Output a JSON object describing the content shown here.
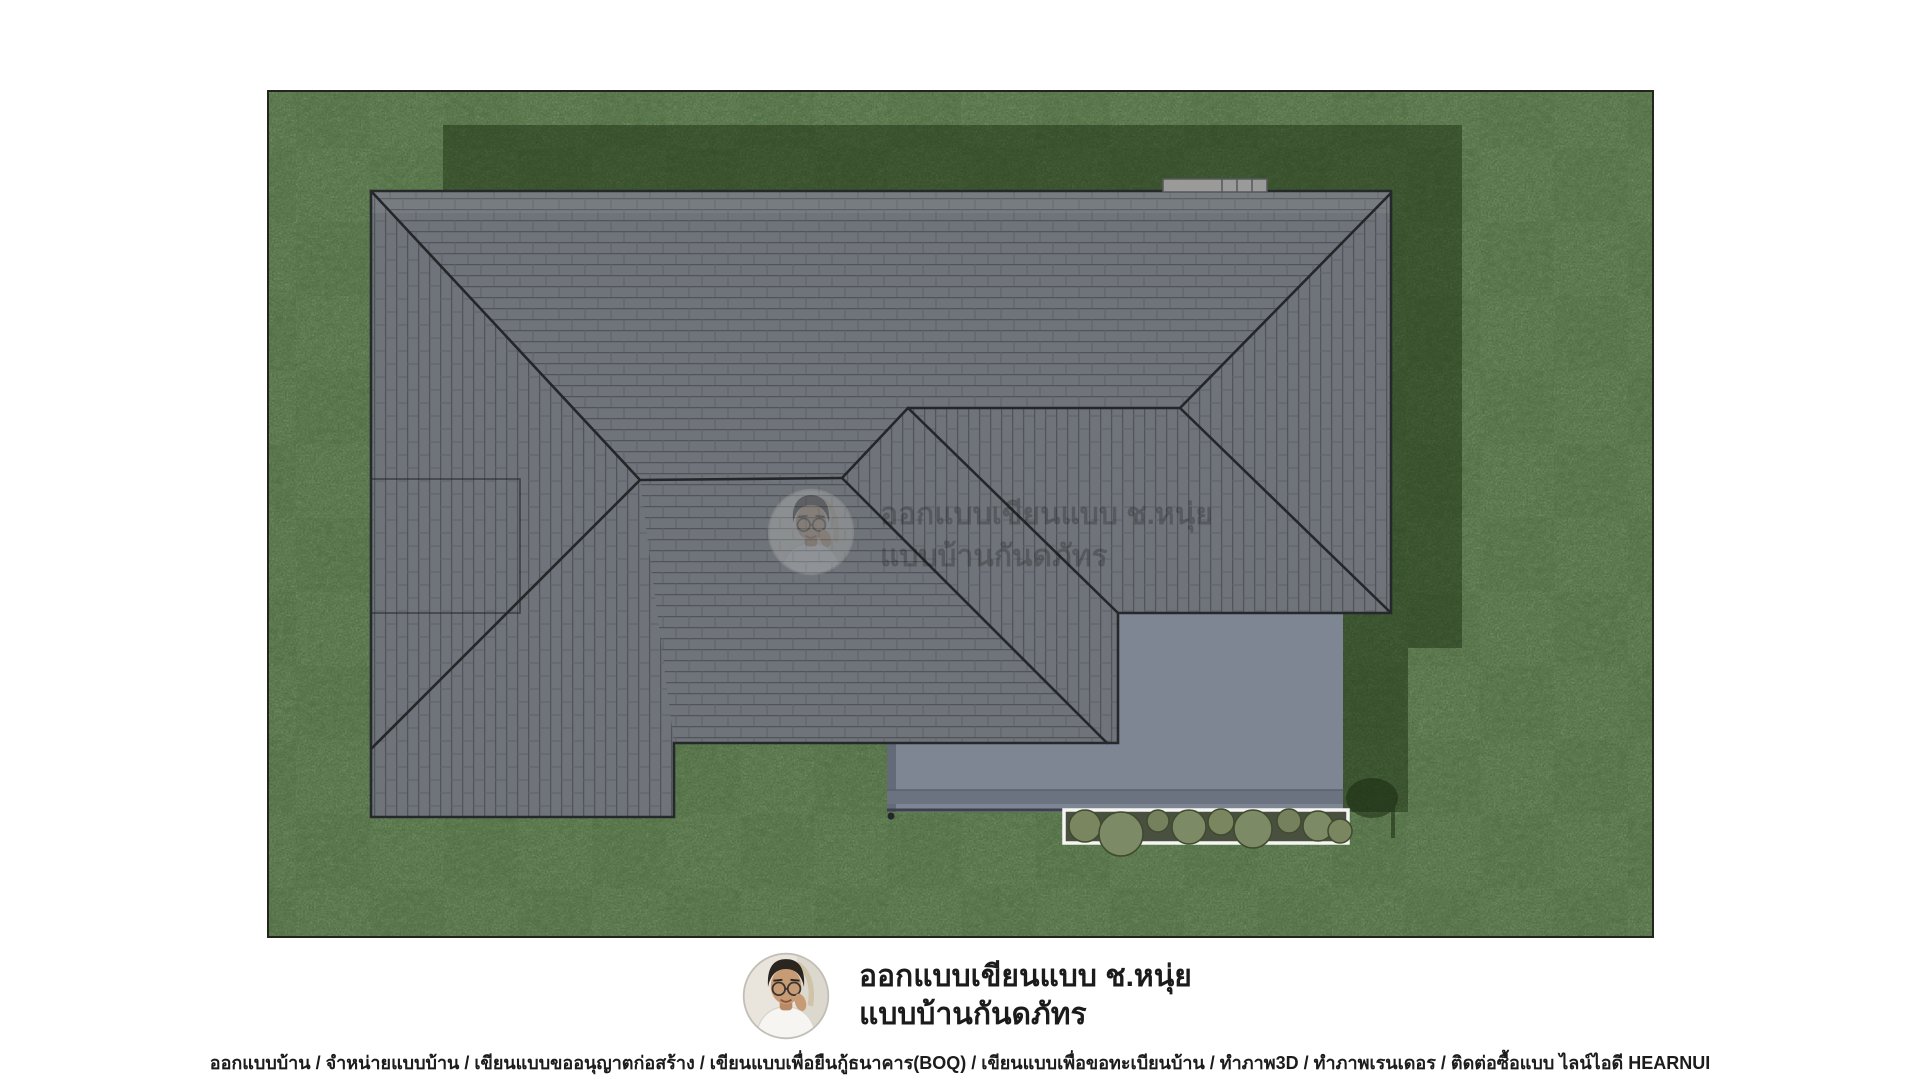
{
  "brand": {
    "title_line1": "ออกแบบเขียนแบบ ช.หนุ่ย",
    "title_line2": "แบบบ้านกันดภัทร"
  },
  "watermark": {
    "line1": "ออกแบบเขียนแบบ ช.หนุ่ย",
    "line2": "แบบบ้านกันดภัทร"
  },
  "footer": {
    "text": "ออกแบบบ้าน / จำหน่ายแบบบ้าน / เขียนแบบขออนุญาตก่อสร้าง / เขียนแบบเพื่อยืนกู้ธนาคาร(BOQ) / เขียนแบบเพื่อขอทะเบียนบ้าน / ทำภาพ3D / ทำภาพเรนเดอร / ติดต่อซื้อแบบ ไลน์ไอดี HEARNUI"
  },
  "colors": {
    "page_bg": "#ffffff",
    "grass": "#5e7c50",
    "grass_shadow": "#31492a",
    "roof_tile": "#6f747a",
    "roof_edge": "#26292c",
    "slab": "#7e8694",
    "slab_fascia": "#6b7380",
    "shrub": "#7d8a66",
    "planter_frame": "#f5f5f3",
    "vent": "#9a9a98"
  }
}
